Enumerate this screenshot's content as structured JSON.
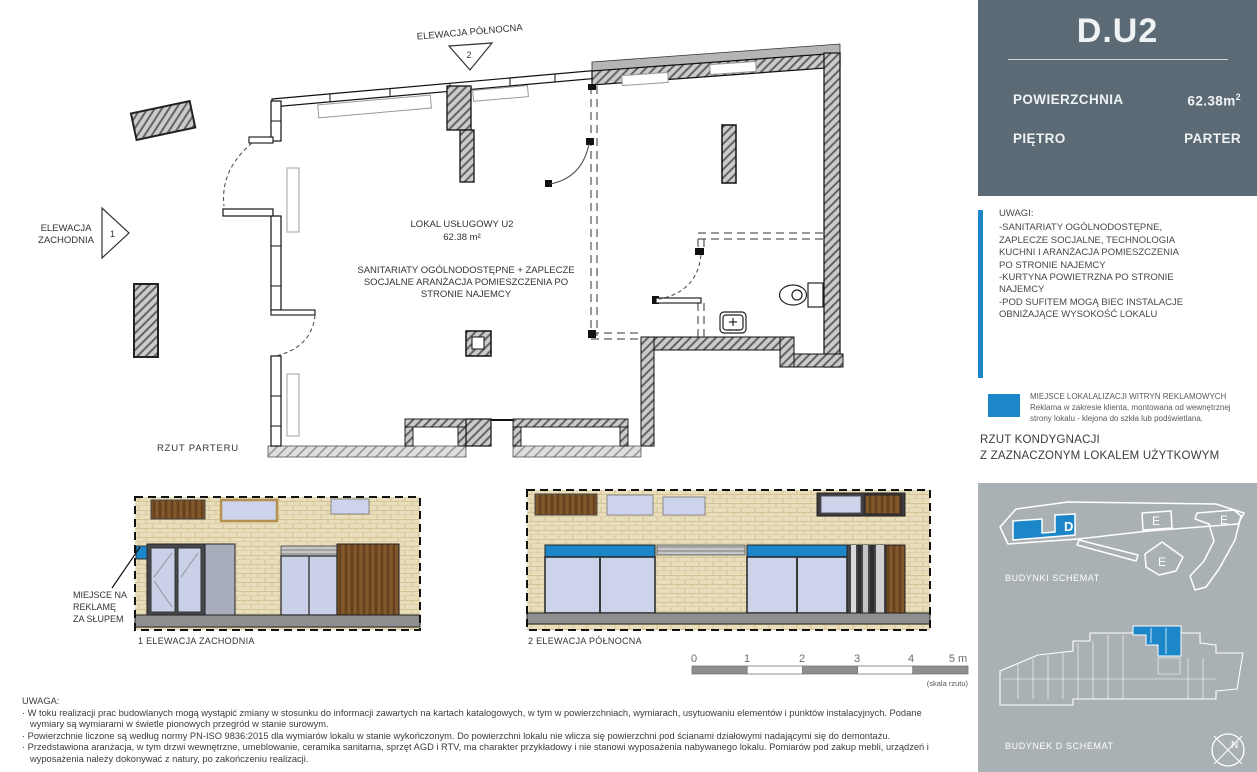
{
  "colors": {
    "accent_blue": "#1b86c8",
    "panel_dark": "#5b6a74",
    "panel_gray": "#a9b1b5"
  },
  "header": {
    "unit_id": "D.U2",
    "area_label": "POWIERZCHNIA",
    "area_value": "62.38m",
    "area_sup": "2",
    "floor_label": "PIĘTRO",
    "floor_value": "PARTER"
  },
  "notes": {
    "title": "UWAGI:",
    "text": "-SANITARIATY OGÓLNODOSTĘPNE,\nZAPLECZE SOCJALNE, TECHNOLOGIA\nKUCHNI I ARANŻACJA POMIESZCZENIA\nPO STRONIE NAJEMCY\n-KURTYNA POWIETRZNA PO STRONIE\nNAJEMCY\n-POD SUFITEM MOGĄ BIEC INSTALACJE\nOBNIŻAJĄCE WYSOKOŚĆ LOKALU"
  },
  "legend": {
    "title": "MIEJSCE LOKALALIZACJI WITRYN REKLAMOWYCH",
    "description": "Reklama w zakresie klienta, montowana od wewnętrznej\nstrony lokalu - klejona do szkła lub podświetlana."
  },
  "section_heading": {
    "line1": "RZUT KONDYGNACJI",
    "line2": "Z ZAZNACZONYM LOKALEM UŻYTKOWYM"
  },
  "floor_plan": {
    "north_elevation_label": "ELEWACJA PÓŁNOCNA",
    "north_marker": "2",
    "west_elevation_line1": "ELEWACJA",
    "west_elevation_line2": "ZACHODNIA",
    "west_marker": "1",
    "unit_label": "LOKAL USŁUGOWY U2",
    "unit_area": "62.38 m²",
    "annotation_line1": "SANITARIATY OGÓLNODOSTĘPNE + ZAPLECZE",
    "annotation_line2": "SOCJALNE ARANŻACJA POMIESZCZENIA PO",
    "annotation_line3": "STRONIE NAJEMCY",
    "caption": "RZUT PARTERU",
    "ad_note_line1": "MIEJSCE NA",
    "ad_note_line2": "REKLAMĘ",
    "ad_note_line3": "ZA SŁUPEM"
  },
  "elevations": {
    "west_caption": "1 ELEWACJA ZACHODNIA",
    "north_caption": "2 ELEWACJA PÓŁNOCNA"
  },
  "scale_bar": {
    "tick0": "0",
    "tick1": "1",
    "tick2": "2",
    "tick3": "3",
    "tick4": "4",
    "tick5": "5 m",
    "note": "(skala rzutu)"
  },
  "site_plan": {
    "caption": "BUDYNKI SCHEMAT",
    "label_d": "D",
    "label_e1": "E",
    "label_e2": "E",
    "label_e3": "E"
  },
  "building_plan": {
    "caption": "BUDYNEK D SCHEMAT",
    "compass": "N"
  },
  "disclaimer": {
    "title": "UWAGA:",
    "bullet1": "· W toku realizacji prac budowlanych mogą wystąpić zmiany w stosunku do informacji zawartych na kartach katalogowych, w tym w powierzchniach, wymiarach, usytuowaniu elementów i punktów instalacyjnych. Podane wymiary są wymiarami w świetle pionowych przegród w stanie surowym.",
    "bullet2": "· Powierzchnie liczone są według normy PN-ISO 9836:2015 dla wymiarów lokalu w stanie wykończonym. Do powierzchni lokalu nie wlicza się powierzchni pod ścianami działowymi nadającymi się do demontażu.",
    "bullet3": "· Przedstawiona aranżacja, w tym drzwi wewnętrzne, umeblowanie, ceramika sanitarna, sprzęt AGD i RTV, ma charakter przykładowy i nie stanowi wyposażenia nabywanego lokalu. Pomiarów pod zakup mebli, urządzeń i wyposażenia należy dokonywać z natury, po zakończeniu realizacji."
  }
}
